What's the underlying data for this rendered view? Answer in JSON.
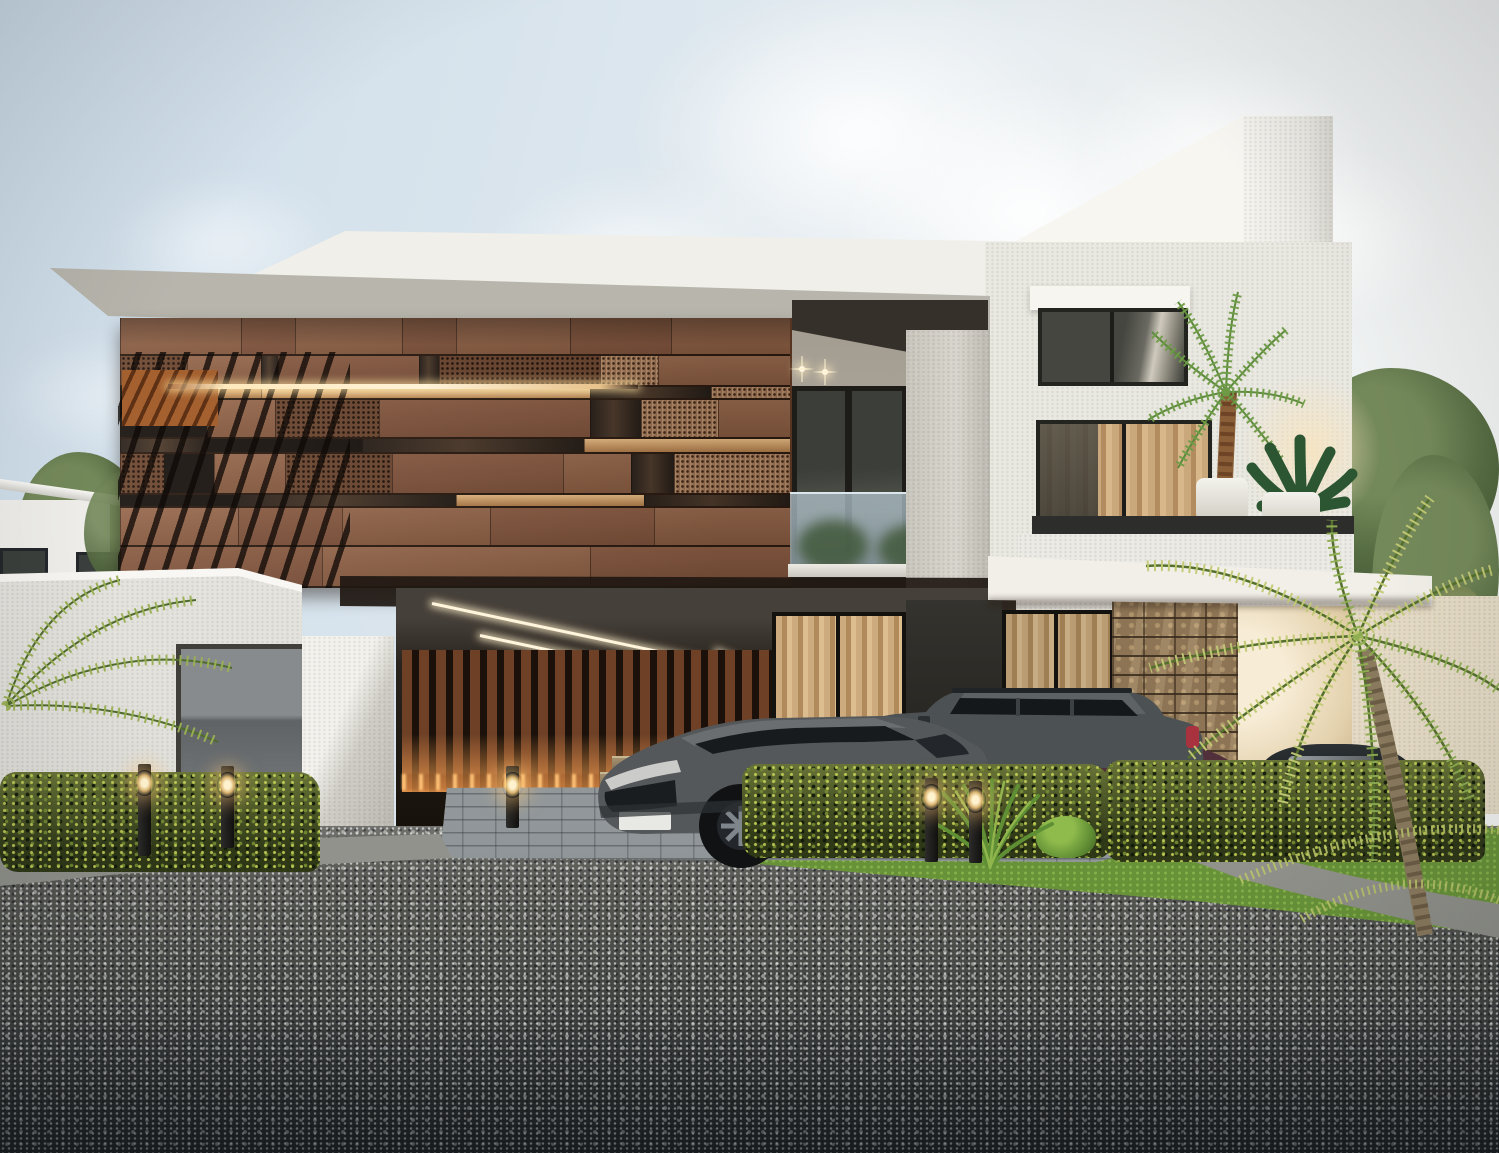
{
  "scene": {
    "type": "architectural-exterior-render",
    "subject": "modern two-storey villa with copper panel facade, carport, two SUVs, hedges, palms and gravel driveway at dusk",
    "visible_text": "none"
  },
  "palette": {
    "sky_left": "#cdddea",
    "sky_right": "#f2f3f2",
    "cloud": "#ffffff",
    "slab_concrete": "#a8a69d",
    "white_wall": "#e9e8e1",
    "fin_white": "#f0efe9",
    "panel_solid": "#8f6348",
    "panel_perforated": "#6d4730",
    "panel_copper": "#a97c5b",
    "panel_glass": "#2a211b",
    "warm_light": "#ffe2ae",
    "open_shadow": "#1a1410",
    "stone_wall": "#8d7454",
    "slat_wood": "#6e4026",
    "curtain_tan": "#c9a87c",
    "hedge_green": "#3d4a1e",
    "hedge_highlight": "#c4d058",
    "lawn_green": "#679238",
    "curb_concrete": "#c9c9c1",
    "paver_gray": "#9aa0a2",
    "road_light": "#a5a5a1",
    "road_dark": "#40454a",
    "car_gray": "#51565a",
    "car_maroon": "#5a3340",
    "tail_red": "#c0333e",
    "glow_amber": "#ffc878",
    "frond_green": "#7f9a45",
    "frond_yellow": "#c2ca74",
    "trunk_brown": "#8a7a5e"
  },
  "sky": {
    "clouds": [
      {
        "x": 540,
        "y": -80,
        "w": 640,
        "h": 430,
        "o": 0.95
      },
      {
        "x": 760,
        "y": 30,
        "w": 540,
        "h": 370,
        "o": 0.97
      },
      {
        "x": 420,
        "y": 130,
        "w": 430,
        "h": 270,
        "o": 0.75
      },
      {
        "x": 60,
        "y": 150,
        "w": 330,
        "h": 190,
        "o": 0.55
      },
      {
        "x": -50,
        "y": 310,
        "w": 310,
        "h": 170,
        "o": 0.5
      },
      {
        "x": 150,
        "y": 420,
        "w": 270,
        "h": 130,
        "o": 0.42
      },
      {
        "x": 1010,
        "y": 10,
        "w": 430,
        "h": 310,
        "o": 0.85
      },
      {
        "x": 1170,
        "y": 110,
        "w": 320,
        "h": 250,
        "o": 0.75
      },
      {
        "x": 290,
        "y": 510,
        "w": 210,
        "h": 95,
        "o": 0.35
      }
    ]
  },
  "facade": {
    "x": 120,
    "y": 318,
    "w": 672,
    "h": 270,
    "rows": [
      {
        "h": 0.14,
        "segs": [
          {
            "w": 0.18,
            "t": "s"
          },
          {
            "w": 0.08,
            "t": "s2"
          },
          {
            "w": 0.16,
            "t": "s"
          },
          {
            "w": 0.08,
            "t": "s2"
          },
          {
            "w": 0.17,
            "t": "s"
          },
          {
            "w": 0.15,
            "t": "s2"
          },
          {
            "w": 0.18,
            "t": "s"
          }
        ]
      },
      {
        "h": 0.115,
        "segs": [
          {
            "w": 0.1,
            "t": "p"
          },
          {
            "w": 0.11,
            "t": "s"
          },
          {
            "w": 0.025,
            "t": "g"
          },
          {
            "w": 0.21,
            "t": "s2"
          },
          {
            "w": 0.03,
            "t": "g"
          },
          {
            "w": 0.24,
            "t": "p"
          },
          {
            "w": 0.085,
            "t": "p2"
          },
          {
            "w": 0.2,
            "t": "s"
          }
        ]
      },
      {
        "h": 0.05,
        "segs": [
          {
            "w": 0.08,
            "t": "o"
          },
          {
            "w": 0.13,
            "t": "w"
          },
          {
            "w": 0.49,
            "t": "w2"
          },
          {
            "w": 0.18,
            "t": "g"
          },
          {
            "w": 0.12,
            "t": "p2"
          }
        ]
      },
      {
        "h": 0.145,
        "segs": [
          {
            "w": 0.13,
            "t": "o"
          },
          {
            "w": 0.1,
            "t": "s"
          },
          {
            "w": 0.155,
            "t": "p"
          },
          {
            "w": 0.315,
            "t": "s2"
          },
          {
            "w": 0.075,
            "t": "g"
          },
          {
            "w": 0.115,
            "t": "p2"
          },
          {
            "w": 0.11,
            "t": "s"
          }
        ]
      },
      {
        "h": 0.055,
        "segs": [
          {
            "w": 0.13,
            "t": "g"
          },
          {
            "w": 0.23,
            "t": "o"
          },
          {
            "w": 0.33,
            "t": "g"
          },
          {
            "w": 0.31,
            "t": "w"
          }
        ]
      },
      {
        "h": 0.15,
        "segs": [
          {
            "w": 0.065,
            "t": "p"
          },
          {
            "w": 0.075,
            "t": "o"
          },
          {
            "w": 0.105,
            "t": "s"
          },
          {
            "w": 0.16,
            "t": "p"
          },
          {
            "w": 0.255,
            "t": "s2"
          },
          {
            "w": 0.1,
            "t": "s"
          },
          {
            "w": 0.065,
            "t": "g"
          },
          {
            "w": 0.175,
            "t": "p2"
          }
        ]
      },
      {
        "h": 0.05,
        "segs": [
          {
            "w": 0.17,
            "t": "o"
          },
          {
            "w": 0.33,
            "t": "g"
          },
          {
            "w": 0.28,
            "t": "w"
          },
          {
            "w": 0.22,
            "t": "g"
          }
        ]
      },
      {
        "h": 0.145,
        "segs": [
          {
            "w": 0.175,
            "t": "s"
          },
          {
            "w": 0.155,
            "t": "s2"
          },
          {
            "w": 0.22,
            "t": "s"
          },
          {
            "w": 0.245,
            "t": "s2"
          },
          {
            "w": 0.205,
            "t": "s"
          }
        ]
      },
      {
        "h": 0.15,
        "segs": [
          {
            "w": 0.3,
            "t": "s2"
          },
          {
            "w": 0.4,
            "t": "s"
          },
          {
            "w": 0.3,
            "t": "s2"
          }
        ]
      }
    ]
  },
  "lights": {
    "bollards": [
      {
        "x": 138,
        "y": 764,
        "h": 92
      },
      {
        "x": 221,
        "y": 766,
        "h": 82
      },
      {
        "x": 506,
        "y": 766,
        "h": 62
      },
      {
        "x": 925,
        "y": 778,
        "h": 84
      },
      {
        "x": 969,
        "y": 781,
        "h": 82
      }
    ],
    "downlights": [
      {
        "x": 799,
        "y": 366
      },
      {
        "x": 822,
        "y": 369
      }
    ],
    "ceiling_leds": [
      {
        "x": 432,
        "y": 602,
        "w": 300,
        "rot": 12
      },
      {
        "x": 480,
        "y": 634,
        "w": 240,
        "rot": 12
      },
      {
        "x": 716,
        "y": 650,
        "w": 150,
        "rot": 22
      }
    ]
  },
  "vehicles": [
    {
      "id": "suv-front",
      "desc": "dark gray SUV front three-quarter view parked in driveway"
    },
    {
      "id": "suv-side",
      "desc": "dark gray boxy SUV side view with roof rails and red tail light"
    },
    {
      "id": "coupe-maroon",
      "desc": "dark maroon coupe partially hidden behind hedge"
    },
    {
      "id": "car-right",
      "desc": "dark car glimpsed behind palm fronds far right"
    }
  ]
}
